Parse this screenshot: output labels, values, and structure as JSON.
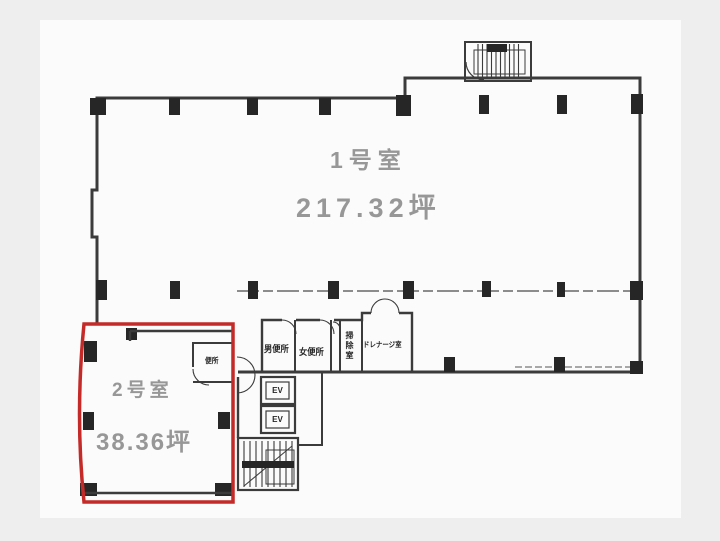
{
  "document": {
    "type": "floor-plan",
    "language": "ja"
  },
  "colors": {
    "paper": "#fbfbfb",
    "background": "#eeeeee",
    "wall": "#3b3b3b",
    "column": "#262626",
    "highlight_outline": "#c42a28",
    "room_label_gray": "#979797",
    "small_label_dark": "#262626"
  },
  "rooms": {
    "room1": {
      "name": "1号室",
      "area": "217.32坪"
    },
    "room2": {
      "name": "2号室",
      "area": "38.36坪"
    },
    "facilities": {
      "mens_toilet": "男便所",
      "womens_toilet": "女便所",
      "cleaning_room": "掃除室",
      "drainage_room": "ドレナージ室",
      "small_toilet": "便所",
      "elevator_1": "EV",
      "elevator_2": "EV"
    }
  }
}
